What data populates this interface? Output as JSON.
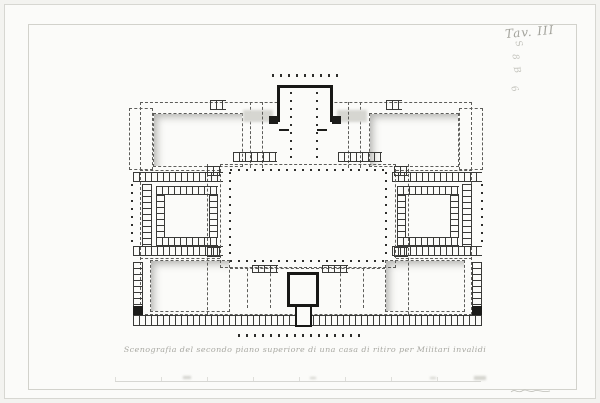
{
  "colors": {
    "paper": "#fbfbf9",
    "ink": "#1c1c1a",
    "dash_line": "#5d5d5a",
    "faint_gray": "#a9a9a3"
  },
  "annotations": {
    "plate_label": "Tav. III",
    "pencil_marks": [
      "S",
      "8",
      "B",
      "6"
    ]
  },
  "caption": {
    "text": "Scenografia del secondo piano superiore di una casa di ritiro per Militari invalidi"
  },
  "plan": {
    "elements": [
      {
        "t": "dashed-rect",
        "n": "outer-envelope",
        "x": 140,
        "y": 102,
        "w": 332,
        "h": 213
      },
      {
        "t": "dashed-rect",
        "n": "wing-top-left",
        "x": 129,
        "y": 108,
        "w": 24,
        "h": 62
      },
      {
        "t": "dashed-rect",
        "n": "wing-top-right",
        "x": 459,
        "y": 108,
        "w": 24,
        "h": 62
      },
      {
        "t": "dashed-v",
        "n": "corridor-left",
        "x": 207,
        "y": 164,
        "h": 151
      },
      {
        "t": "dashed-v",
        "n": "corridor-right",
        "x": 408,
        "y": 164,
        "h": 151
      },
      {
        "t": "dashed-h",
        "n": "row-divider",
        "x": 140,
        "y": 170,
        "w": 80
      },
      {
        "t": "dashed-h",
        "n": "row-divider",
        "x": 396,
        "y": 170,
        "w": 76
      },
      {
        "t": "dashed-h",
        "n": "row-divider",
        "x": 140,
        "y": 258,
        "w": 80
      },
      {
        "t": "dashed-h",
        "n": "row-divider",
        "x": 396,
        "y": 258,
        "w": 76
      },
      {
        "t": "dashed-v",
        "n": "vestibule-corridor",
        "x": 250,
        "y": 102,
        "h": 66
      },
      {
        "t": "dashed-v",
        "n": "vestibule-corridor",
        "x": 360,
        "y": 102,
        "h": 66
      },
      {
        "t": "court",
        "n": "court-top-left",
        "x": 153,
        "y": 113,
        "w": 90,
        "h": 54
      },
      {
        "t": "court",
        "n": "court-top-right",
        "x": 369,
        "y": 113,
        "w": 90,
        "h": 54
      },
      {
        "t": "ladder-h",
        "n": "pier-chip",
        "x": 210,
        "y": 100,
        "w": 16,
        "h": 10
      },
      {
        "t": "ladder-h",
        "n": "pier-chip",
        "x": 386,
        "y": 100,
        "w": 16,
        "h": 10
      },
      {
        "t": "shade",
        "n": "wall-shadow",
        "x": 243,
        "y": 110,
        "w": 30,
        "h": 12
      },
      {
        "t": "shade",
        "n": "wall-shadow",
        "x": 337,
        "y": 110,
        "w": 30,
        "h": 12
      },
      {
        "t": "wall-open-b",
        "n": "chapel-block",
        "x": 277,
        "y": 85,
        "w": 56,
        "h": 37
      },
      {
        "t": "black",
        "n": "chapel-pier",
        "x": 269,
        "y": 116,
        "w": 9,
        "h": 8
      },
      {
        "t": "black",
        "n": "chapel-pier",
        "x": 332,
        "y": 116,
        "w": 9,
        "h": 8
      },
      {
        "t": "dots-h",
        "n": "portico-colonnade",
        "x": 272,
        "y": 74,
        "w": 66,
        "h": 3
      },
      {
        "t": "dots-v",
        "n": "vestibule-columns",
        "x": 290,
        "y": 92,
        "w": 2,
        "h": 70
      },
      {
        "t": "dots-v",
        "n": "vestibule-columns",
        "x": 316,
        "y": 92,
        "w": 2,
        "h": 70
      },
      {
        "t": "black",
        "n": "wall-stub",
        "x": 279,
        "y": 129,
        "w": 10,
        "h": 2
      },
      {
        "t": "black",
        "n": "wall-stub",
        "x": 317,
        "y": 129,
        "w": 10,
        "h": 2
      },
      {
        "t": "dashed-v",
        "n": "vestibule-side",
        "x": 262,
        "y": 102,
        "h": 66
      },
      {
        "t": "dashed-v",
        "n": "vestibule-side",
        "x": 348,
        "y": 102,
        "h": 66
      },
      {
        "t": "ladder-h",
        "n": "arcade-strip",
        "x": 233,
        "y": 152,
        "w": 44,
        "h": 10
      },
      {
        "t": "ladder-h",
        "n": "arcade-strip",
        "x": 338,
        "y": 152,
        "w": 44,
        "h": 10
      },
      {
        "t": "ladder-h",
        "n": "arcade-band",
        "x": 133,
        "y": 172,
        "w": 90,
        "h": 10
      },
      {
        "t": "ladder-h",
        "n": "arcade-band",
        "x": 392,
        "y": 172,
        "w": 90,
        "h": 10
      },
      {
        "t": "ladder-h",
        "n": "arcade-band",
        "x": 133,
        "y": 246,
        "w": 90,
        "h": 10
      },
      {
        "t": "ladder-h",
        "n": "arcade-band",
        "x": 392,
        "y": 246,
        "w": 90,
        "h": 10
      },
      {
        "t": "dots-v",
        "n": "edge-colonnade",
        "x": 131,
        "y": 184,
        "w": 2,
        "h": 62
      },
      {
        "t": "dots-v",
        "n": "edge-colonnade",
        "x": 481,
        "y": 184,
        "w": 2,
        "h": 62
      },
      {
        "t": "ladder-v",
        "n": "edge-range",
        "x": 142,
        "y": 184,
        "w": 10,
        "h": 62
      },
      {
        "t": "ladder-v",
        "n": "edge-range",
        "x": 462,
        "y": 184,
        "w": 10,
        "h": 62
      },
      {
        "t": "ladder-h",
        "n": "arcade-court-left",
        "x": 156,
        "y": 186,
        "w": 62,
        "h": 9
      },
      {
        "t": "ladder-h",
        "n": "arcade-court-left",
        "x": 156,
        "y": 237,
        "w": 62,
        "h": 9
      },
      {
        "t": "ladder-v",
        "n": "arcade-court-left",
        "x": 156,
        "y": 195,
        "w": 9,
        "h": 42
      },
      {
        "t": "ladder-v",
        "n": "arcade-court-left",
        "x": 209,
        "y": 195,
        "w": 9,
        "h": 42
      },
      {
        "t": "ladder-h",
        "n": "arcade-court-right",
        "x": 397,
        "y": 186,
        "w": 62,
        "h": 9
      },
      {
        "t": "ladder-h",
        "n": "arcade-court-right",
        "x": 397,
        "y": 237,
        "w": 62,
        "h": 9
      },
      {
        "t": "ladder-v",
        "n": "arcade-court-right",
        "x": 397,
        "y": 195,
        "w": 9,
        "h": 42
      },
      {
        "t": "ladder-v",
        "n": "arcade-court-right",
        "x": 450,
        "y": 195,
        "w": 9,
        "h": 42
      },
      {
        "t": "dashed-rect",
        "n": "central-court",
        "x": 220,
        "y": 164,
        "w": 176,
        "h": 104
      },
      {
        "t": "dots-h",
        "n": "central-colonnade",
        "x": 230,
        "y": 169,
        "w": 156,
        "h": 2
      },
      {
        "t": "dots-h",
        "n": "central-colonnade",
        "x": 230,
        "y": 260,
        "w": 156,
        "h": 2
      },
      {
        "t": "dots-v",
        "n": "central-colonnade",
        "x": 229,
        "y": 172,
        "w": 2,
        "h": 88
      },
      {
        "t": "dots-v",
        "n": "central-colonnade",
        "x": 385,
        "y": 172,
        "w": 2,
        "h": 88
      },
      {
        "t": "ladder-h",
        "n": "stair-chip",
        "x": 207,
        "y": 166,
        "w": 14,
        "h": 10
      },
      {
        "t": "ladder-h",
        "n": "stair-chip",
        "x": 394,
        "y": 166,
        "w": 14,
        "h": 10
      },
      {
        "t": "ladder-h",
        "n": "stair-chip",
        "x": 207,
        "y": 247,
        "w": 14,
        "h": 10
      },
      {
        "t": "ladder-h",
        "n": "stair-chip",
        "x": 394,
        "y": 247,
        "w": 14,
        "h": 10
      },
      {
        "t": "court",
        "n": "court-bottom-left",
        "x": 150,
        "y": 260,
        "w": 80,
        "h": 52
      },
      {
        "t": "court",
        "n": "court-bottom-right",
        "x": 385,
        "y": 260,
        "w": 80,
        "h": 52
      },
      {
        "t": "ladder-v",
        "n": "edge-range",
        "x": 133,
        "y": 262,
        "w": 10,
        "h": 53
      },
      {
        "t": "ladder-v",
        "n": "edge-range",
        "x": 472,
        "y": 262,
        "w": 10,
        "h": 53
      },
      {
        "t": "black",
        "n": "corner-pier",
        "x": 133,
        "y": 306,
        "w": 10,
        "h": 9
      },
      {
        "t": "black",
        "n": "corner-pier",
        "x": 472,
        "y": 306,
        "w": 10,
        "h": 9
      },
      {
        "t": "dashed-h",
        "n": "south-rooms",
        "x": 230,
        "y": 268,
        "w": 155
      },
      {
        "t": "dashed-v",
        "n": "south-rooms",
        "x": 247,
        "y": 268,
        "h": 40
      },
      {
        "t": "dashed-v",
        "n": "south-rooms",
        "x": 270,
        "y": 268,
        "h": 40
      },
      {
        "t": "dashed-v",
        "n": "south-rooms",
        "x": 340,
        "y": 268,
        "h": 40
      },
      {
        "t": "dashed-v",
        "n": "south-rooms",
        "x": 363,
        "y": 268,
        "h": 40
      },
      {
        "t": "ladder-h",
        "n": "stair-chip",
        "x": 252,
        "y": 265,
        "w": 26,
        "h": 8
      },
      {
        "t": "ladder-h",
        "n": "stair-chip",
        "x": 322,
        "y": 265,
        "w": 26,
        "h": 8
      },
      {
        "t": "ladder-h",
        "n": "south-range",
        "x": 133,
        "y": 315,
        "w": 349,
        "h": 11
      },
      {
        "t": "dots-h",
        "n": "south-colonnade",
        "x": 238,
        "y": 334,
        "w": 128,
        "h": 3
      },
      {
        "t": "wall",
        "n": "south-pavilion",
        "x": 287,
        "y": 272,
        "w": 32,
        "h": 35
      },
      {
        "t": "wall-open-t",
        "n": "south-stem",
        "x": 295,
        "y": 307,
        "w": 17,
        "h": 20
      },
      {
        "t": "smudge",
        "n": "faint-mark",
        "x": 183,
        "y": 376,
        "w": 8,
        "h": 3
      },
      {
        "t": "smudge",
        "n": "faint-mark",
        "x": 310,
        "y": 377,
        "w": 6,
        "h": 2
      },
      {
        "t": "smudge",
        "n": "faint-mark",
        "x": 430,
        "y": 377,
        "w": 6,
        "h": 2
      },
      {
        "t": "smudge",
        "n": "faint-mark",
        "x": 474,
        "y": 376,
        "w": 12,
        "h": 4
      }
    ]
  }
}
